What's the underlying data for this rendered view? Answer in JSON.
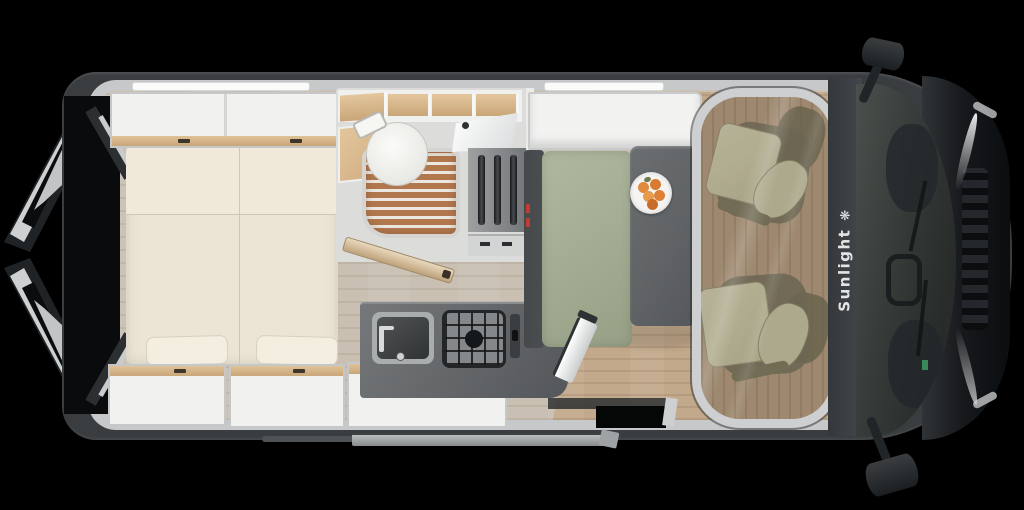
{
  "brand": {
    "label": "Sunlight",
    "icon_glyph": "❋",
    "icon_name": "sun-logo-icon"
  },
  "colors": {
    "body": "#3a3d40",
    "hood": "#17191c",
    "wall": "#c7c8c9",
    "floor": "#c9c0b3",
    "wood": "#c3a98b",
    "cabwood": "#bda387",
    "mattress": "#ece5d6",
    "cabinetwood": "#d9b88c",
    "unit": "#f1f1f0",
    "counter": "#616466",
    "bench": "#a4ae94",
    "benchdark": "#4b4e51",
    "tabletop": "#606365",
    "showerwood": "#b1774d",
    "toilet": "#f7f7f5",
    "seat": "#d4d0af",
    "seatdark": "#847e64",
    "glass": "#343a37",
    "accentred": "#c23b31",
    "brandtext": "#e2e4e4",
    "fruit": "#dd8138"
  }
}
